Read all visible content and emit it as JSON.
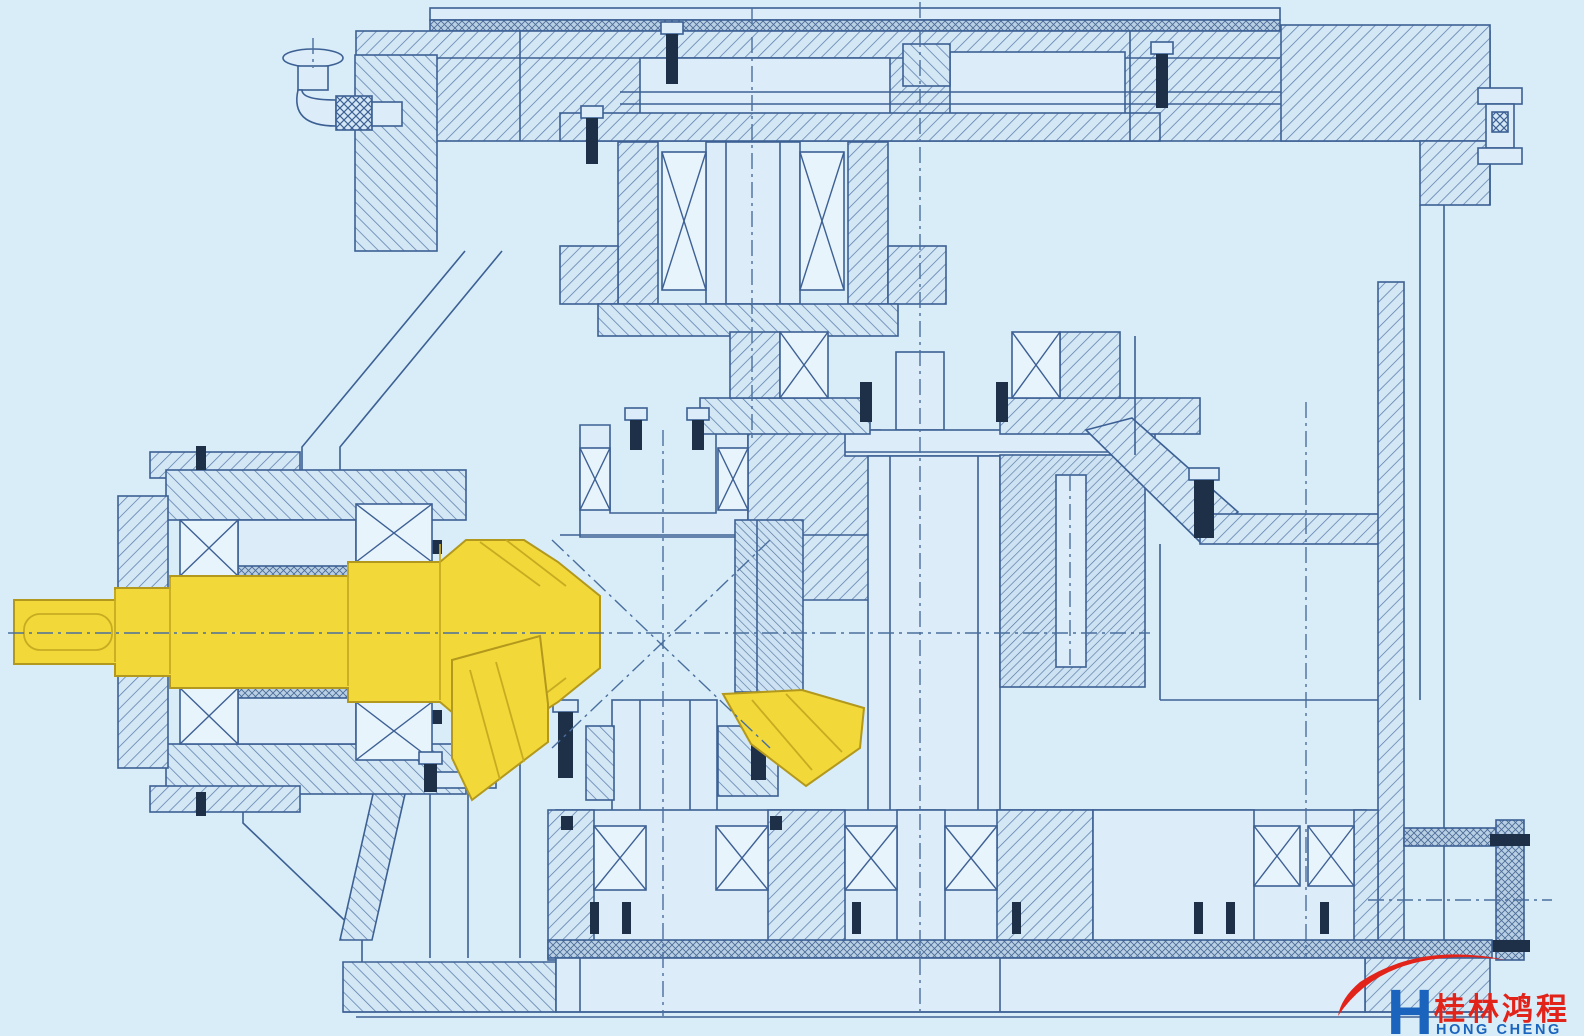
{
  "figure": {
    "kind": "sectional engineering drawing of a bevel-gear reducer",
    "highlighted_part": "input bevel pinion shaft"
  },
  "logo": {
    "monogram": "H",
    "chinese": "桂林鸿程",
    "english": "HONG CHENG"
  },
  "colors": {
    "background": "#d8edf8",
    "line": "#3d6094",
    "hatch": "#5b7dab",
    "plate": "#dcecf8",
    "highlight": "#f2d838",
    "highlight_edge": "#b2981c",
    "dark_hardware": "#1e3048",
    "logo_red": "#e2231a",
    "logo_blue": "#1b64bd"
  }
}
